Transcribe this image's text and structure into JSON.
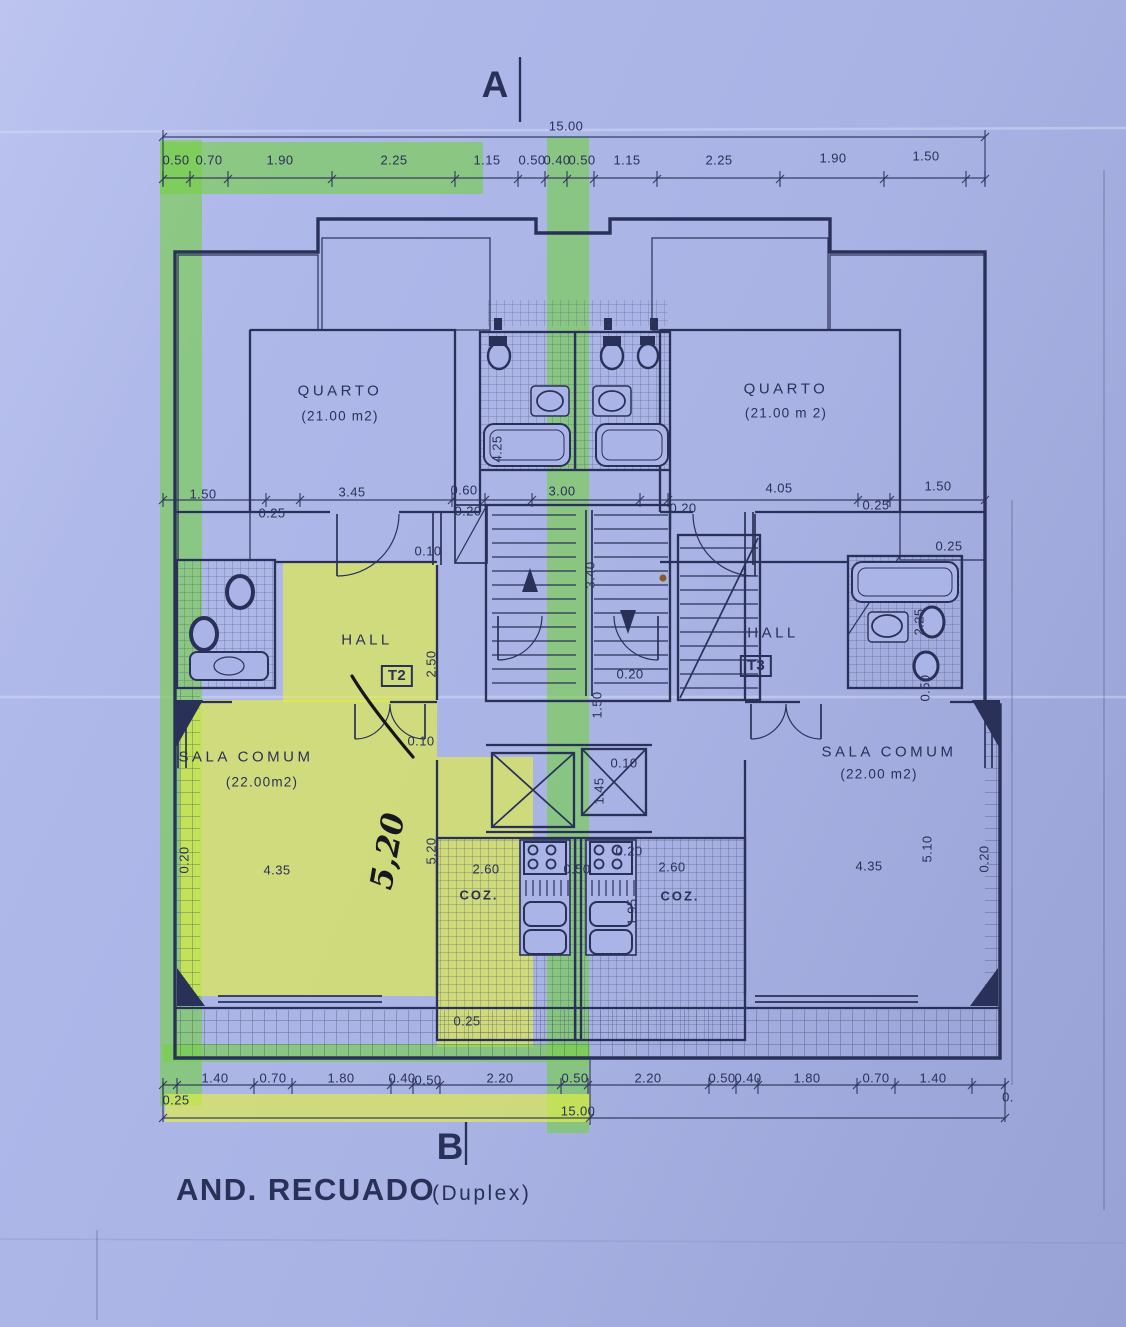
{
  "title": {
    "main": "AND. RECUADO",
    "suffix": "(Duplex)"
  },
  "markers": {
    "section_a": "A",
    "section_b": "B"
  },
  "colors": {
    "paper": "#aab4e6",
    "ink": "#2a3158",
    "highlight_green": "#76d046",
    "highlight_yellow": "#e2ee46"
  },
  "dims": {
    "top_total": "15.00",
    "bottom_total": "15.00",
    "mid_left_hatch": "1.50",
    "mid_left_inset": "0.25",
    "quarto_left_w": "3.45",
    "closet_w": "0.60",
    "closet_inset": "0.20",
    "center_w": "3.00",
    "right_inset_a": "0.20",
    "quarto_right_w": "4.05",
    "right_inset_b": "0.25",
    "right_hatch": "1.50",
    "right_hatch_inset": "0.25",
    "quarto_left_h": "4.25",
    "wall_a": "0.10",
    "wall_b": "0.10",
    "stair_core_w": "3.40",
    "hall_left_stair": "2.50",
    "stair_bottom_inset": "0.20",
    "corridor_h": "1.50",
    "elevator_inset": "0.10",
    "elevator_w": "1.45",
    "bath_right_h": "2.25",
    "bath_right_inset": "0.50",
    "sala_left_wall": "0.20",
    "sala_left_w": "4.35",
    "coz_left_h": "5.20",
    "coz_left_w": "2.60",
    "coz_center": "0.50",
    "coz_right_inset": "0.20",
    "coz_right_w": "2.60",
    "coz_right_h": "1.95",
    "sala_right_w": "4.35",
    "sala_right_h": "5.10",
    "sala_right_wall": "0.20",
    "balcony_inset": "0.25",
    "bottom_left_offset": "0.25",
    "bottom_right_edge": "0."
  },
  "dim_top": [
    "0.50",
    "0.70",
    "1.90",
    "2.25",
    "1.15",
    "0.50",
    "0.40",
    "0.50",
    "1.15",
    "2.25",
    "1.90",
    "1.50"
  ],
  "dim_bottom": [
    "1.40",
    "0.70",
    "1.80",
    "0.40",
    "0.50",
    "2.20",
    "0.50",
    "2.20",
    "0.50",
    "0.40",
    "1.80",
    "0.70",
    "1.40"
  ],
  "rooms": {
    "quarto_left": {
      "name": "QUARTO",
      "area": "(21.00 m2)"
    },
    "quarto_right": {
      "name": "QUARTO",
      "area": "(21.00 m 2)"
    },
    "hall_left": {
      "name": "HALL",
      "tag": "T2"
    },
    "hall_right": {
      "name": "HALL",
      "tag": "T3"
    },
    "sala_left": {
      "name": "SALA COMUM",
      "area": "(22.00m2)"
    },
    "sala_right": {
      "name": "SALA COMUM",
      "area": "(22.00 m2)"
    },
    "coz_left": {
      "name": "COZ."
    },
    "coz_right": {
      "name": "COZ."
    }
  },
  "handwritten": {
    "note": "5,20"
  }
}
